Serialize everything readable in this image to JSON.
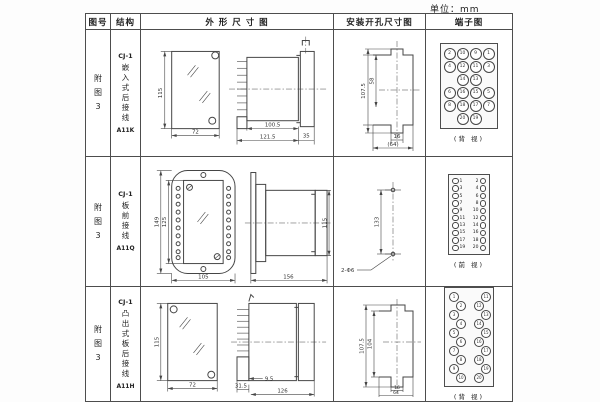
{
  "page": {
    "unit_label": "单位：mm"
  },
  "table": {
    "headers": [
      "图号",
      "结构",
      "外 形 尺 寸 图",
      "安装开孔尺寸图",
      "端子图"
    ],
    "rows": [
      {
        "fig_lines": [
          "附",
          "图",
          "3"
        ],
        "structure_top": "CJ-1",
        "structure_chars": [
          "嵌",
          "入",
          "式",
          "后",
          "接",
          "线"
        ],
        "structure_code": "A11K",
        "outline": {
          "front_h": "115",
          "front_w": "72",
          "d1": "100.5",
          "d2": "121.5",
          "d3": "35"
        },
        "mount": {
          "v1": "107.5",
          "v2": "58",
          "b1": "16",
          "b2": "(64)"
        },
        "terminal": {
          "type": "grid4",
          "caption": "(背 视)",
          "rows": [
            [
              "2",
              "10",
              "9",
              "1"
            ],
            [
              "4",
              "12",
              "11",
              "3"
            ],
            [
              "",
              "14",
              "13",
              ""
            ],
            [
              "6",
              "16",
              "15",
              "5"
            ],
            [
              "8",
              "18",
              "17",
              "7"
            ],
            [
              "",
              "20",
              "19",
              ""
            ]
          ]
        }
      },
      {
        "fig_lines": [
          "附",
          "图",
          "3"
        ],
        "structure_top": "CJ-1",
        "structure_chars": [
          "板",
          "前",
          "接",
          "线"
        ],
        "structure_code": "A11Q",
        "outline": {
          "h1": "149",
          "h2": "125",
          "w": "105",
          "side_l": "156",
          "side_h": "115"
        },
        "mount": {
          "v1": "133",
          "hole": "2-Φ6"
        },
        "terminal": {
          "type": "strip",
          "caption": "(前 视)",
          "left": [
            "1",
            "3",
            "5",
            "7",
            "9",
            "11",
            "13",
            "15",
            "17",
            "19"
          ],
          "right": [
            "2",
            "4",
            "6",
            "8",
            "10",
            "12",
            "14",
            "16",
            "18",
            "20"
          ]
        }
      },
      {
        "fig_lines": [
          "附",
          "图",
          "3"
        ],
        "structure_top": "CJ-1",
        "structure_chars": [
          "凸",
          "出",
          "式",
          "板",
          "后",
          "接",
          "线"
        ],
        "structure_code": "A11H",
        "outline": {
          "front_h": "115",
          "front_w": "72",
          "d1": "31.5",
          "d2": "9.5",
          "d3": "126"
        },
        "mount": {
          "v1": "107.5",
          "v2": "104",
          "b1": "16",
          "b2": "64"
        },
        "terminal": {
          "type": "zigzag",
          "caption": "(背 视)",
          "left": [
            "1",
            "2",
            "3",
            "4",
            "5",
            "6",
            "7",
            "8",
            "9",
            "10"
          ],
          "right": [
            "11",
            "12",
            "13",
            "14",
            "15",
            "16",
            "17",
            "18",
            "19",
            "20"
          ]
        }
      }
    ]
  }
}
